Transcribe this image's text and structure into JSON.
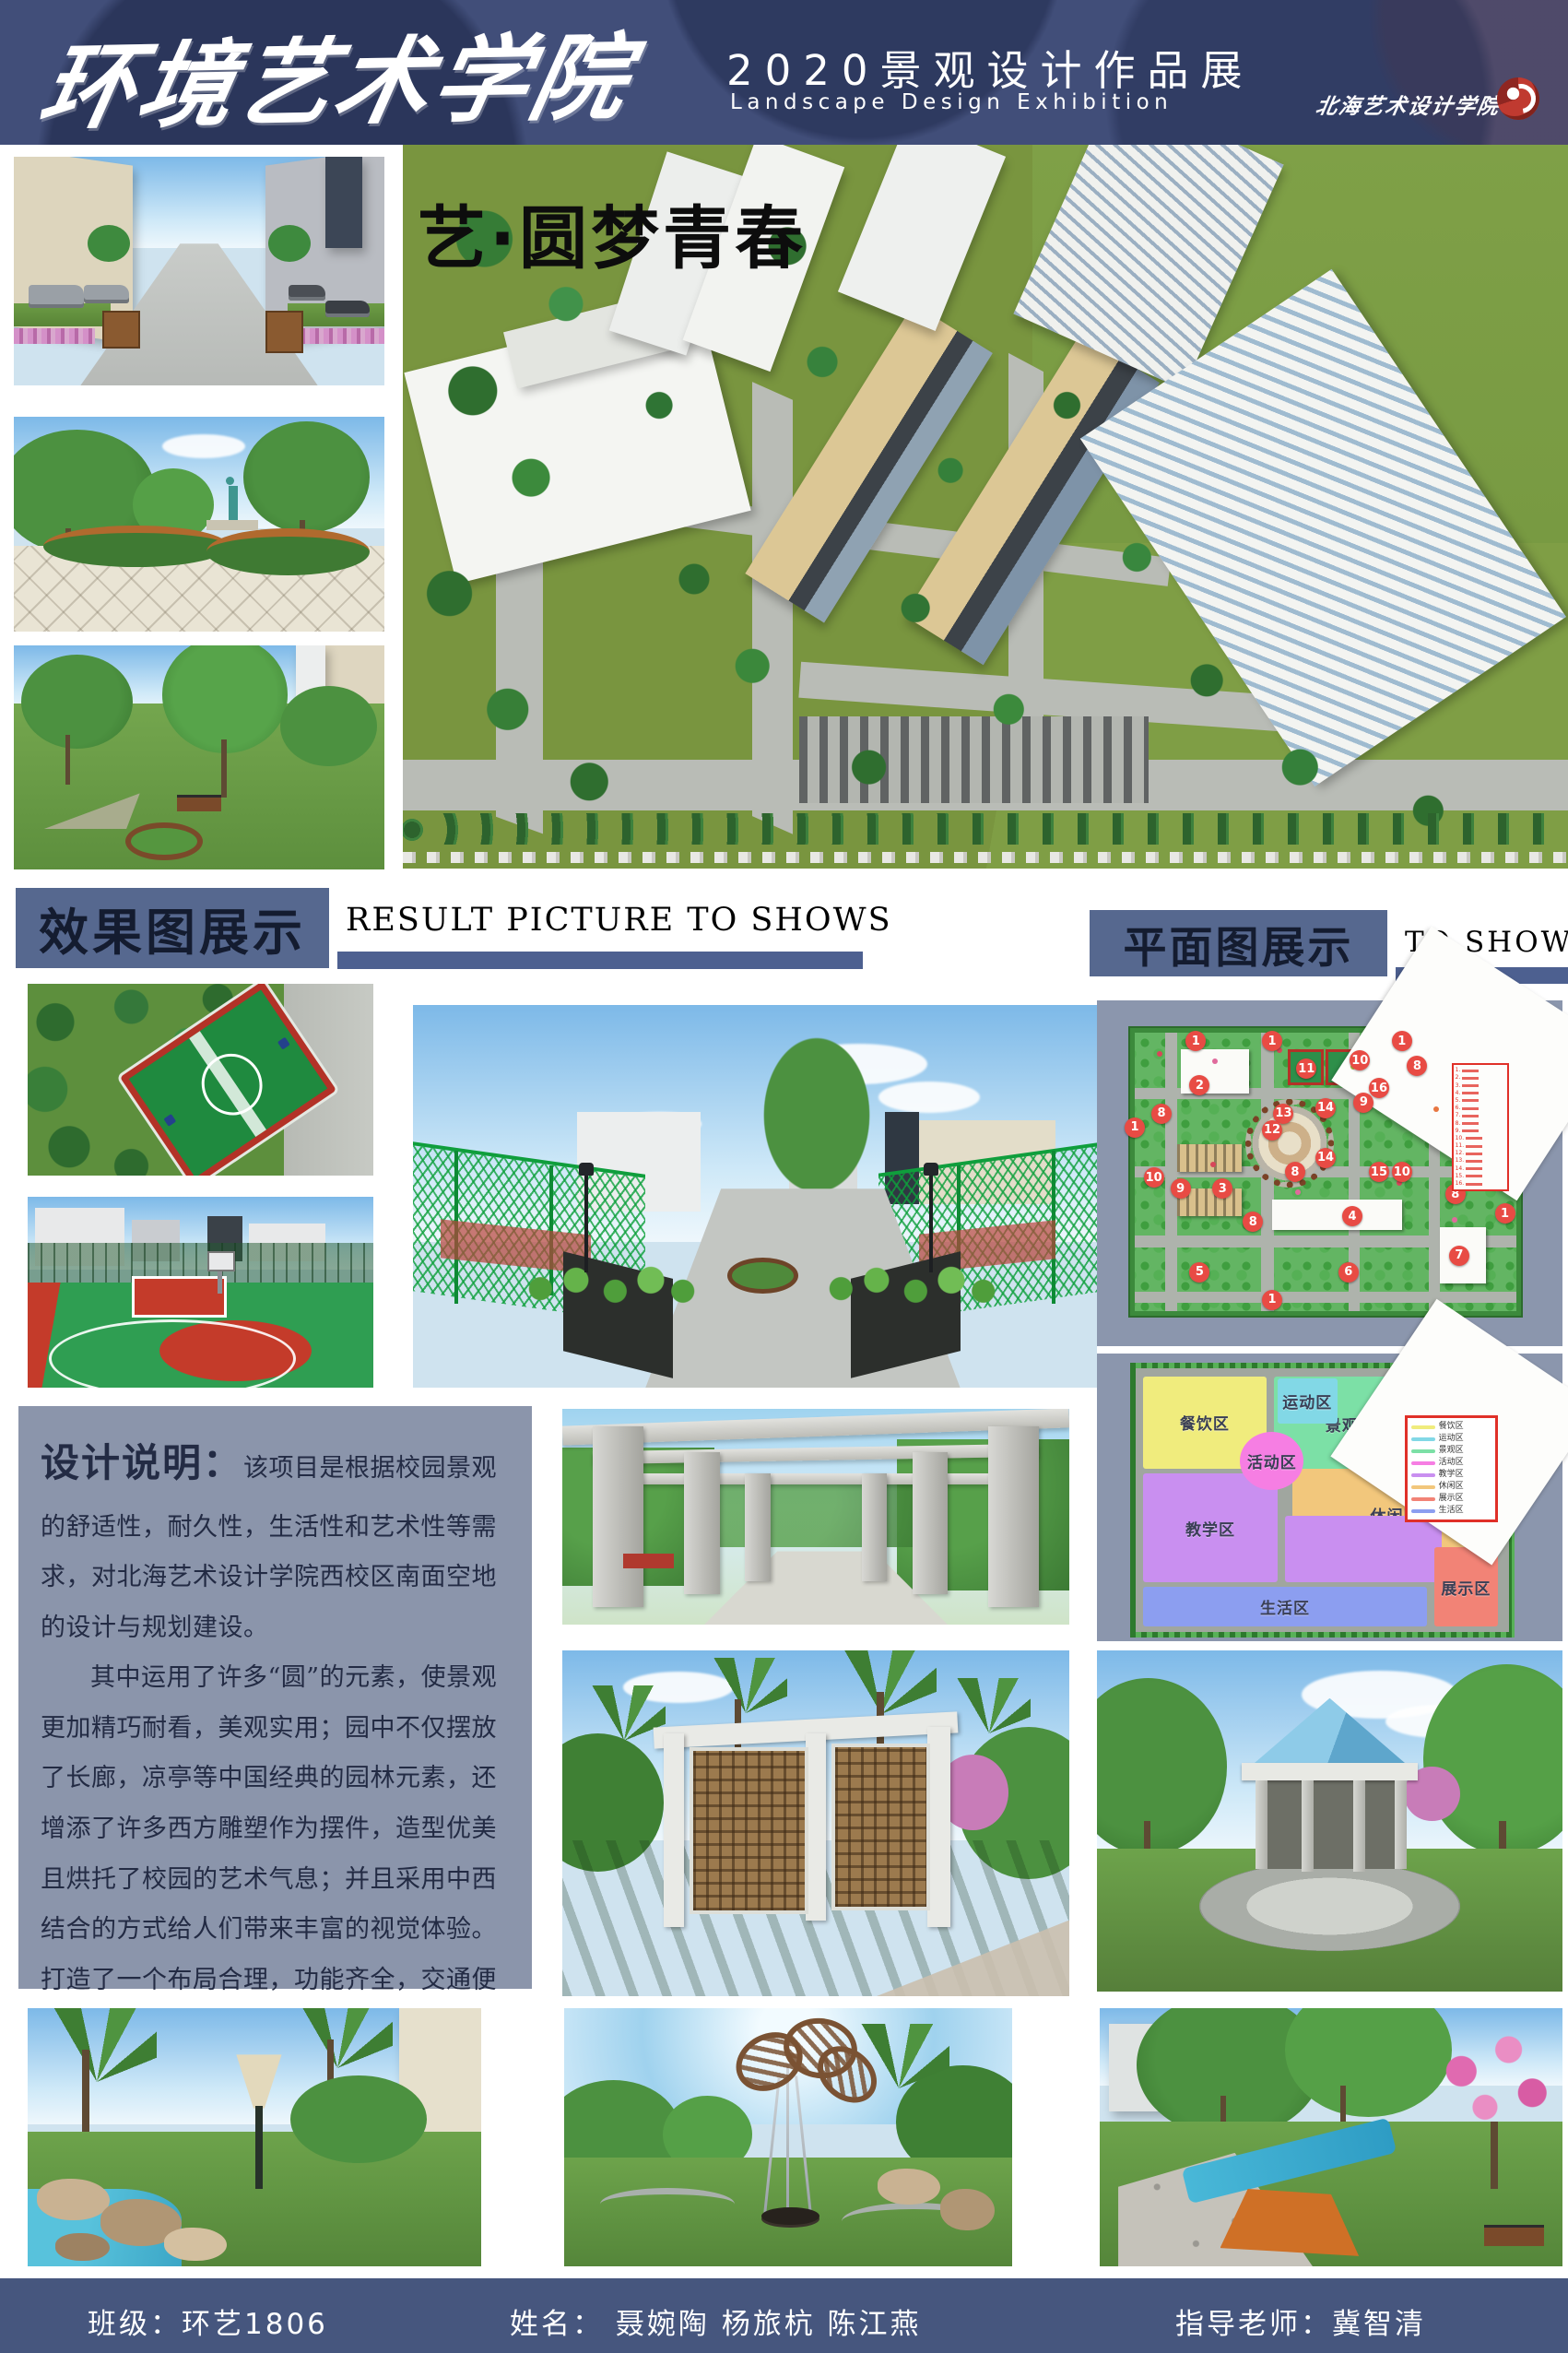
{
  "header": {
    "school_name": "环境艺术学院",
    "exhibition_title": "2020景观设计作品展",
    "exhibition_subtitle": "Landscape Design Exhibition",
    "logo_text": "北海艺术设计学院",
    "logo_icon": "red-swirl",
    "bg_color": "#414e79"
  },
  "hero": {
    "title": "艺·圆梦青春"
  },
  "sections": {
    "results": {
      "title_cn": "效果图展示",
      "title_en": "RESULT PICTURE TO SHOWS"
    },
    "plans": {
      "title_cn": "平面图展示",
      "title_en": "TO SHOWS"
    }
  },
  "description": {
    "label": "设计说明：",
    "para1": "该项目是根据校园景观的舒适性，耐久性，生活性和艺术性等需求，对北海艺术设计学院西校区南面空地的设计与规划建设。",
    "para2": "其中运用了许多“圆”的元素，使景观更加精巧耐看，美观实用；园中不仅摆放了长廊，凉亭等中国经典的园林元素，还增添了许多西方雕塑作为摆件，造型优美且烘托了校园的艺术气息；并且采用中西结合的方式给人们带来丰富的视觉体验。打造了一个布局合理，功能齐全，交通便利，环境优美且充满艺术气息的校园景观。"
  },
  "site_plan": {
    "marker_color": "#e84b44",
    "legend_border_color": "#e03028",
    "legend_numbers": [
      "1.",
      "2.",
      "3.",
      "4.",
      "5.",
      "6.",
      "7.",
      "8.",
      "9.",
      "10.",
      "11.",
      "12.",
      "13.",
      "14.",
      "15.",
      "16."
    ],
    "markers": [
      {
        "n": "1",
        "x": 16,
        "y": 3
      },
      {
        "n": "1",
        "x": 36,
        "y": 3
      },
      {
        "n": "1",
        "x": 70,
        "y": 3
      },
      {
        "n": "1",
        "x": 0,
        "y": 34
      },
      {
        "n": "1",
        "x": 97,
        "y": 65
      },
      {
        "n": "1",
        "x": 36,
        "y": 96
      },
      {
        "n": "2",
        "x": 17,
        "y": 19
      },
      {
        "n": "11",
        "x": 45,
        "y": 13
      },
      {
        "n": "10",
        "x": 59,
        "y": 10
      },
      {
        "n": "8",
        "x": 74,
        "y": 12
      },
      {
        "n": "16",
        "x": 64,
        "y": 20
      },
      {
        "n": "9",
        "x": 60,
        "y": 25
      },
      {
        "n": "8",
        "x": 7,
        "y": 29
      },
      {
        "n": "13",
        "x": 39,
        "y": 29
      },
      {
        "n": "14",
        "x": 50,
        "y": 27
      },
      {
        "n": "12",
        "x": 36,
        "y": 35
      },
      {
        "n": "14",
        "x": 50,
        "y": 45
      },
      {
        "n": "8",
        "x": 42,
        "y": 50
      },
      {
        "n": "15",
        "x": 64,
        "y": 50
      },
      {
        "n": "10",
        "x": 70,
        "y": 50
      },
      {
        "n": "10",
        "x": 5,
        "y": 52
      },
      {
        "n": "9",
        "x": 12,
        "y": 56
      },
      {
        "n": "3",
        "x": 23,
        "y": 56
      },
      {
        "n": "8",
        "x": 31,
        "y": 68
      },
      {
        "n": "8",
        "x": 84,
        "y": 58
      },
      {
        "n": "4",
        "x": 57,
        "y": 66
      },
      {
        "n": "7",
        "x": 85,
        "y": 80
      },
      {
        "n": "5",
        "x": 17,
        "y": 86
      },
      {
        "n": "6",
        "x": 56,
        "y": 86
      }
    ]
  },
  "zoning": {
    "zones": [
      {
        "name": "餐饮区",
        "color": "#f0ec7d"
      },
      {
        "name": "运动区",
        "color": "#82d8e6"
      },
      {
        "name": "景观区",
        "color": "#7ce0a6"
      },
      {
        "name": "活动区",
        "color": "#f67ee3"
      },
      {
        "name": "教学区",
        "color": "#c98ff0"
      },
      {
        "name": "休闲区",
        "color": "#f2c77c"
      },
      {
        "name": "展示区",
        "color": "#f28376"
      },
      {
        "name": "生活区",
        "color": "#8c9ef0"
      }
    ]
  },
  "footer": {
    "class_label": "班级：环艺1806",
    "names_label": "姓名：  聂婉陶  杨旅杭  陈江燕",
    "advisor_label": "指导老师：冀智清",
    "bg_color": "#46567e"
  }
}
